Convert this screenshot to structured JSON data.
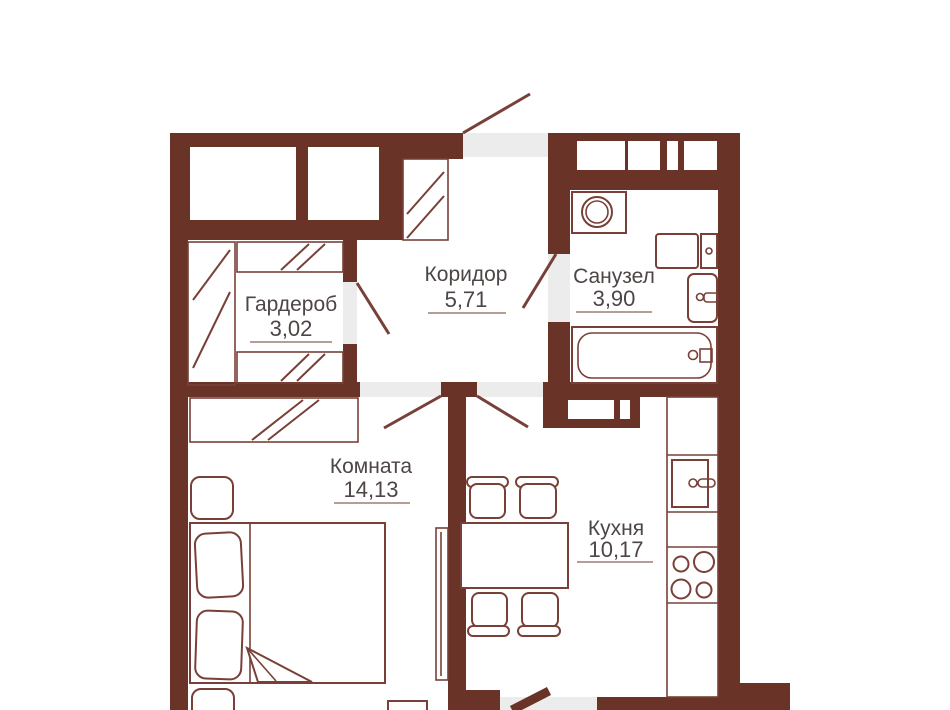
{
  "colors": {
    "wall": "#6A3328",
    "line": "#784038",
    "opening": "#ECECEC",
    "text": "#4E4545",
    "underline": "#9B7E74"
  },
  "rooms": {
    "wardrobe": {
      "label": "Гардероб",
      "area": "3,02"
    },
    "corridor": {
      "label": "Коридор",
      "area": "5,71"
    },
    "bathroom": {
      "label": "Санузел",
      "area": "3,90"
    },
    "room": {
      "label": "Комната",
      "area": "14,13"
    },
    "kitchen": {
      "label": "Кухня",
      "area": "10,17"
    }
  }
}
